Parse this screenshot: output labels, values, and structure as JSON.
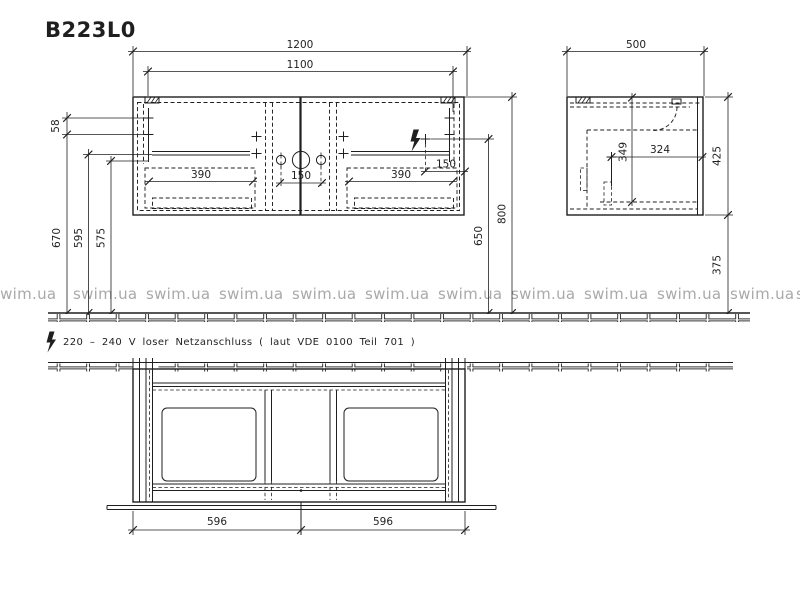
{
  "title": "B223L0",
  "watermark": {
    "text": "swim.ua"
  },
  "note": {
    "text": "220 – 240 V loser Netzanschluss ( laut VDE 0100 Teil 701 )"
  },
  "front_view": {
    "dims": {
      "overall_width": "1200",
      "inner_width": "1100",
      "top_bracket_offset": "58",
      "drawer_width_left": "390",
      "faucet_spacing": "150",
      "drawer_width_right": "390",
      "outlet_side_offset": "150",
      "height_670": "670",
      "height_595": "595",
      "height_575": "575",
      "outlet_height": "650",
      "total_height": "800"
    }
  },
  "side_view": {
    "dims": {
      "depth": "500",
      "inner_depth": "324",
      "inner_height": "349",
      "cabinet_height": "425",
      "floor_clearance": "375"
    }
  },
  "plan_view": {
    "dims": {
      "drawer_left": "596",
      "drawer_right": "596"
    }
  }
}
